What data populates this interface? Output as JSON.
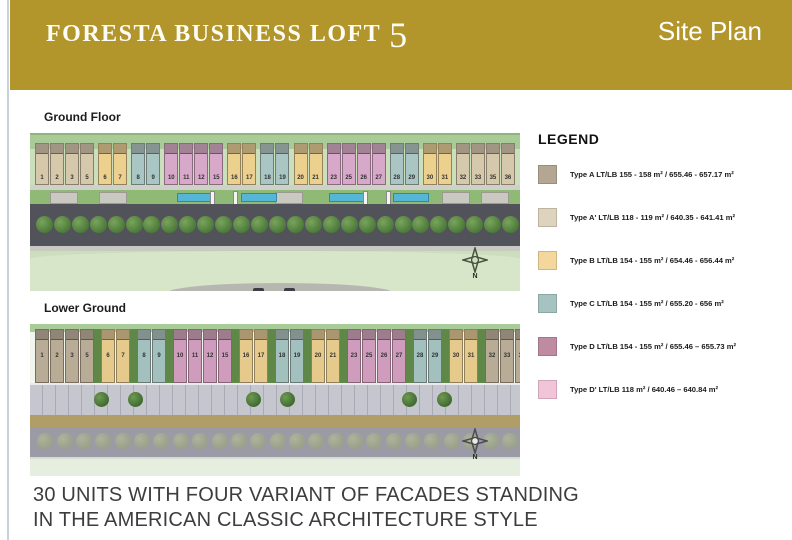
{
  "header": {
    "title": "FORESTA BUSINESS LOFT",
    "title_number": "5",
    "page_label": "Site Plan",
    "bg_color": "#b2952b"
  },
  "plans": [
    {
      "id": "ground-floor",
      "label": "Ground Floor",
      "north_label": "N",
      "groups": [
        {
          "type": "A",
          "units": [
            "1",
            "2",
            "3",
            "5"
          ]
        },
        {
          "type": "B",
          "units": [
            "6",
            "7"
          ]
        },
        {
          "type": "C",
          "units": [
            "8",
            "9"
          ]
        },
        {
          "type": "D",
          "units": [
            "10",
            "11",
            "12",
            "15"
          ]
        },
        {
          "type": "B",
          "units": [
            "16",
            "17"
          ]
        },
        {
          "type": "C",
          "units": [
            "18",
            "19"
          ]
        },
        {
          "type": "B",
          "units": [
            "20",
            "21"
          ]
        },
        {
          "type": "D",
          "units": [
            "23",
            "25",
            "26",
            "27"
          ]
        },
        {
          "type": "C",
          "units": [
            "28",
            "29"
          ]
        },
        {
          "type": "B",
          "units": [
            "30",
            "31"
          ]
        },
        {
          "type": "A",
          "units": [
            "32",
            "33",
            "35",
            "36"
          ]
        }
      ]
    },
    {
      "id": "lower-ground",
      "label": "Lower Ground",
      "north_label": "N",
      "groups": [
        {
          "type": "A",
          "units": [
            "1",
            "2",
            "3",
            "5"
          ]
        },
        {
          "type": "B",
          "units": [
            "6",
            "7"
          ]
        },
        {
          "type": "C",
          "units": [
            "8",
            "9"
          ]
        },
        {
          "type": "D",
          "units": [
            "10",
            "11",
            "12",
            "15"
          ]
        },
        {
          "type": "B",
          "units": [
            "16",
            "17"
          ]
        },
        {
          "type": "C",
          "units": [
            "18",
            "19"
          ]
        },
        {
          "type": "B",
          "units": [
            "20",
            "21"
          ]
        },
        {
          "type": "D",
          "units": [
            "23",
            "25",
            "26",
            "27"
          ]
        },
        {
          "type": "C",
          "units": [
            "28",
            "29"
          ]
        },
        {
          "type": "B",
          "units": [
            "30",
            "31"
          ]
        },
        {
          "type": "A",
          "units": [
            "32",
            "33",
            "35",
            "36"
          ]
        }
      ]
    }
  ],
  "type_colors": {
    "ground-floor": {
      "A": "#d6c9ab",
      "B": "#ecd08e",
      "C": "#a9c6c4",
      "D": "#d8a8ca"
    },
    "lower-ground": {
      "A": "#b9ac96",
      "B": "#e6ca8c",
      "C": "#a2c0be",
      "D": "#cf9cbe"
    }
  },
  "legend": {
    "title": "LEGEND",
    "items": [
      {
        "name": "Type A",
        "spec": "LT/LB 155 - 158 m² / 655.46 - 657.17 m²",
        "color": "#b3a794"
      },
      {
        "name": "Type A'",
        "spec": "LT/LB 118 - 119 m² / 640.35 - 641.41 m²",
        "color": "#ded3bd"
      },
      {
        "name": "Type B",
        "spec": "LT/LB 154 - 155 m² / 654.46 - 656.44 m²",
        "color": "#f3d79d"
      },
      {
        "name": "Type C",
        "spec": "LT/LB 154 - 155 m² / 655.20 - 656 m²",
        "color": "#a5c3c1"
      },
      {
        "name": "Type D",
        "spec": "LT/LB 154 - 155 m² / 655.46 – 655.73 m²",
        "color": "#bf8ba0"
      },
      {
        "name": "Type D'",
        "spec": "LT/LB 118 m² / 640.46 – 640.84 m²",
        "color": "#f2c4d8"
      }
    ]
  },
  "footer": {
    "line1": "30 UNITS WITH FOUR VARIANT OF FACADES STANDING",
    "line2": "IN THE AMERICAN CLASSIC ARCHITECTURE STYLE"
  }
}
